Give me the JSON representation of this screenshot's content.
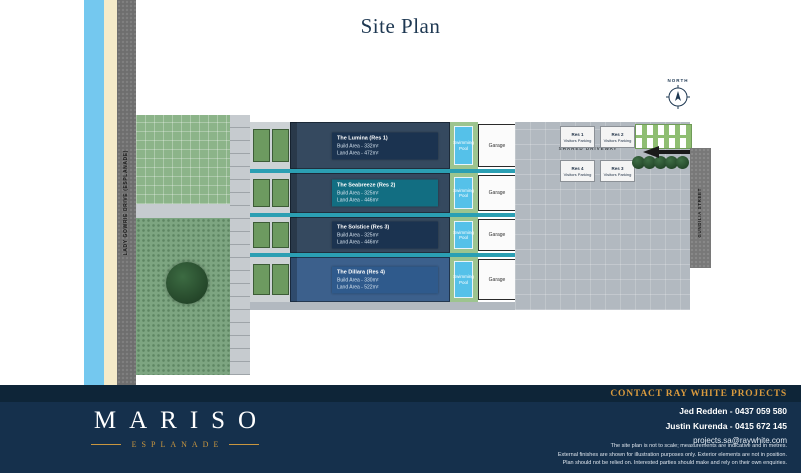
{
  "title": "Site Plan",
  "north_label": "NORTH",
  "roads": {
    "left_road": "LADY GOWRIE DRIVE (ESPLANADE)",
    "right_road": "GUNDILIA STREET"
  },
  "driveway": {
    "label": "SHARED DRIVEWAY",
    "parking": [
      {
        "res": "Res 1",
        "label": "Visitors Parking"
      },
      {
        "res": "Res 2",
        "label": "Visitors Parking"
      },
      {
        "res": "Res 4",
        "label": "Visitors Parking"
      },
      {
        "res": "Res 3",
        "label": "Visitors Parking"
      }
    ]
  },
  "residences": [
    {
      "name": "The Lumina (Res 1)",
      "build_area": "Build Area - 332m²",
      "land_area": "Land Area - 472m²"
    },
    {
      "name": "The Seabreeze (Res 2)",
      "build_area": "Build Area - 325m²",
      "land_area": "Land Area - 446m²"
    },
    {
      "name": "The Solstice (Res 3)",
      "build_area": "Build Area - 325m²",
      "land_area": "Land Area - 446m²"
    },
    {
      "name": "The Dillara (Res 4)",
      "build_area": "Build Area - 330m²",
      "land_area": "Land Area - 522m²"
    }
  ],
  "labels": {
    "pool": "Swimming Pool",
    "garage": "Garage"
  },
  "footer": {
    "contact_heading": "CONTACT RAY WHITE PROJECTS",
    "agents": [
      "Jed Redden - 0437 059 580",
      "Justin Kurenda - 0415 672 145"
    ],
    "email": "projects.sa@raywhite.com",
    "disclaimer": [
      "The site plan is not to scale; measurements are indicative and in metres.",
      "External finishes are shown for illustration purposes only. Exterior elements are not in position.",
      "Plan should not be relied on. Interested parties should make and rely on their own enquiries."
    ],
    "brand": {
      "name": "MARISO",
      "subtitle": "ESPLANADE"
    }
  },
  "colors": {
    "navy": "#15304c",
    "navy_dark": "#0e2538",
    "gold": "#d89a3e",
    "teal_divider": "#2b9fb3",
    "ocean": "#74c8ef",
    "sand": "#f5ebc9",
    "pool": "#55c1e9",
    "roof": "#35495f",
    "roof_res4": "#3c608c",
    "plate_res2": "#126e82",
    "driveway": "#b2b9c0"
  }
}
